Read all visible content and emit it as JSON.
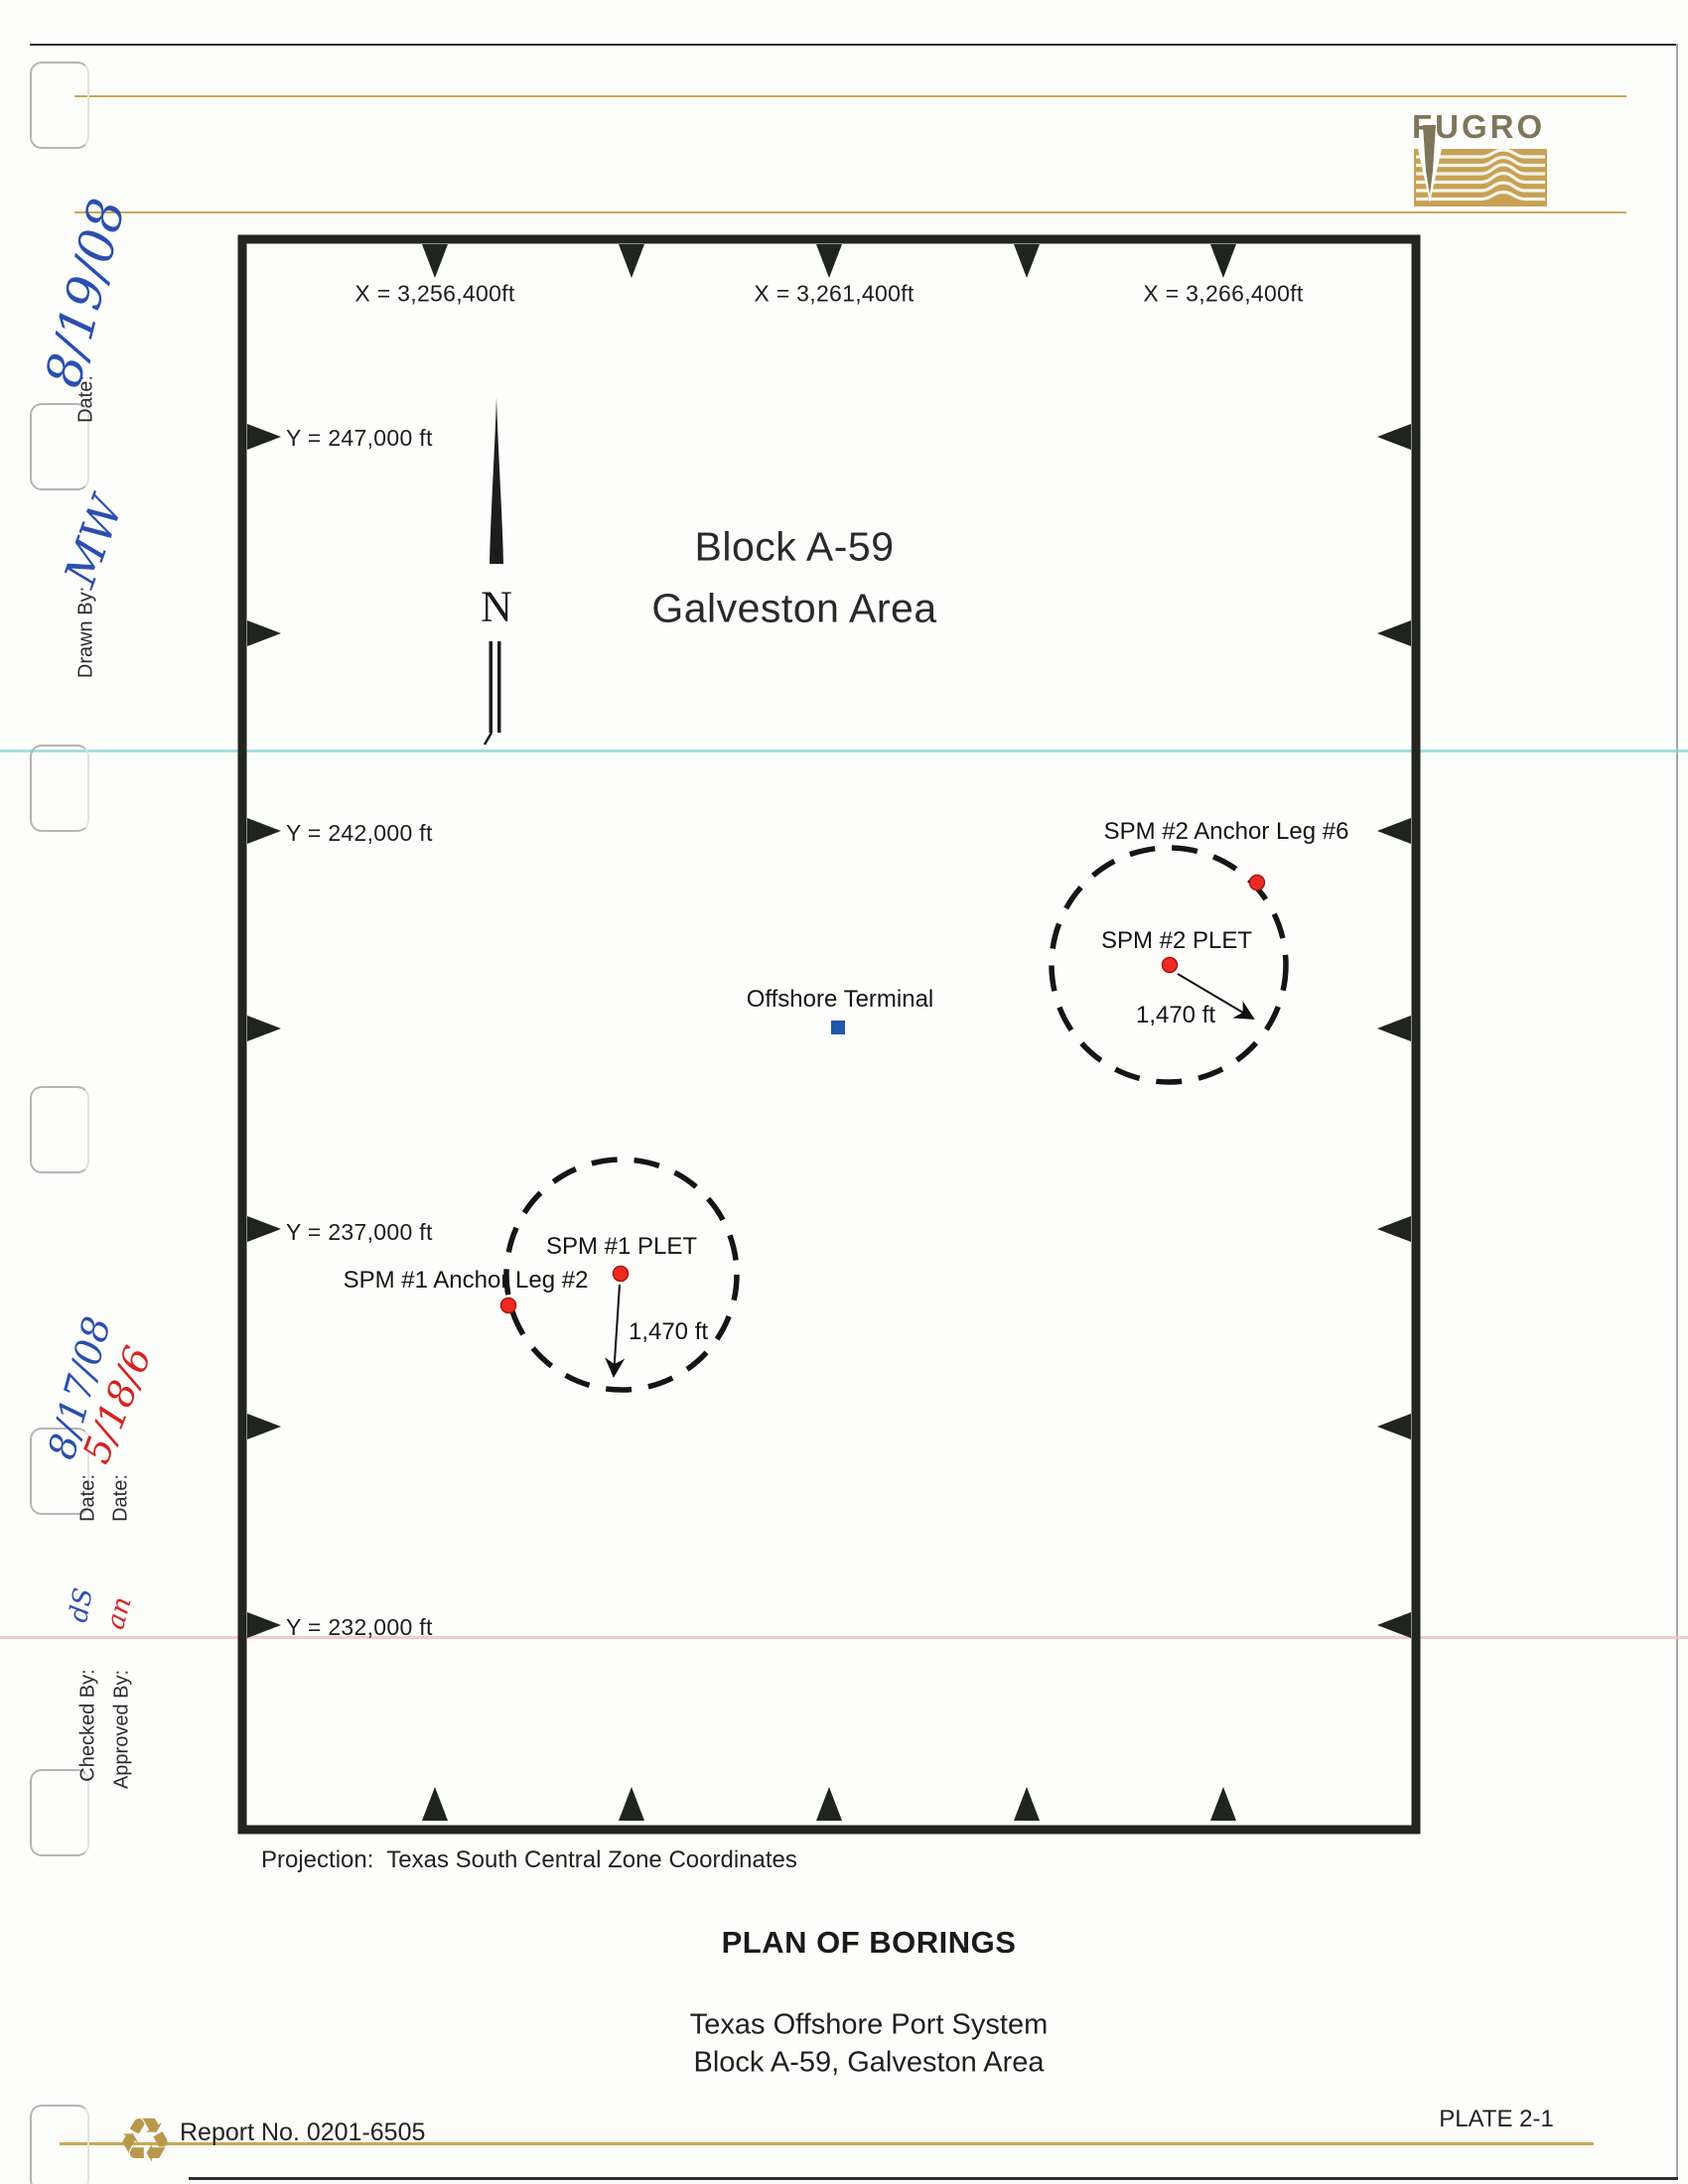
{
  "logo": {
    "wordmark": "FUGRO",
    "block_color": "#c7a155",
    "letter_color": "#7e755b"
  },
  "margin": {
    "fields": [
      {
        "label": "Date:",
        "value": "8/19/08",
        "ink": "blue"
      },
      {
        "label": "Drawn By:",
        "value": "MW",
        "ink": "blue"
      },
      {
        "label": "Date:",
        "value": "8/17/08",
        "ink": "blue"
      },
      {
        "label": "Date:",
        "value": "5/18/6",
        "ink": "red"
      },
      {
        "label": "Checked By:",
        "value": "dS",
        "ink": "blue"
      },
      {
        "label": "Approved By:",
        "value": "an",
        "ink": "red"
      }
    ]
  },
  "map": {
    "title_line1": "Block A-59",
    "title_line2": "Galveston Area",
    "north_label": "N",
    "x_labels": [
      "X = 3,256,400ft",
      "X = 3,261,400ft",
      "X = 3,266,400ft"
    ],
    "y_labels": [
      "Y = 247,000 ft",
      "Y = 242,000 ft",
      "Y = 237,000 ft",
      "Y = 232,000 ft"
    ],
    "grid_spacing_ft": 2500,
    "features": {
      "offshore_terminal": {
        "label": "Offshore Terminal",
        "marker_color": "#2356a8"
      },
      "spm2": {
        "anchor_label": "SPM #2 Anchor Leg #6",
        "plet_label": "SPM #2 PLET",
        "radius_label": "1,470 ft",
        "marker_color": "#ee2b22"
      },
      "spm1": {
        "plet_label": "SPM #1 PLET",
        "anchor_label": "SPM #1 Anchor Leg #2",
        "radius_label": "1,470 ft",
        "marker_color": "#ee2b22"
      }
    }
  },
  "footer": {
    "projection_note": "Projection:  Texas South Central Zone Coordinates",
    "plan_title": "PLAN OF BORINGS",
    "subtitle_line1": "Texas Offshore Port System",
    "subtitle_line2": "Block A-59, Galveston Area",
    "report_no": "Report No. 0201-6505",
    "plate_no": "PLATE 2-1",
    "recycle_icon": "♻"
  },
  "colors": {
    "gold_rule": "#c9a851",
    "cyan_scanline": "#8fd6d8",
    "pink_scanline": "#eec6cb",
    "handwriting_blue": "#2a4fae",
    "handwriting_red": "#d42421",
    "frame_black": "#23251f"
  }
}
